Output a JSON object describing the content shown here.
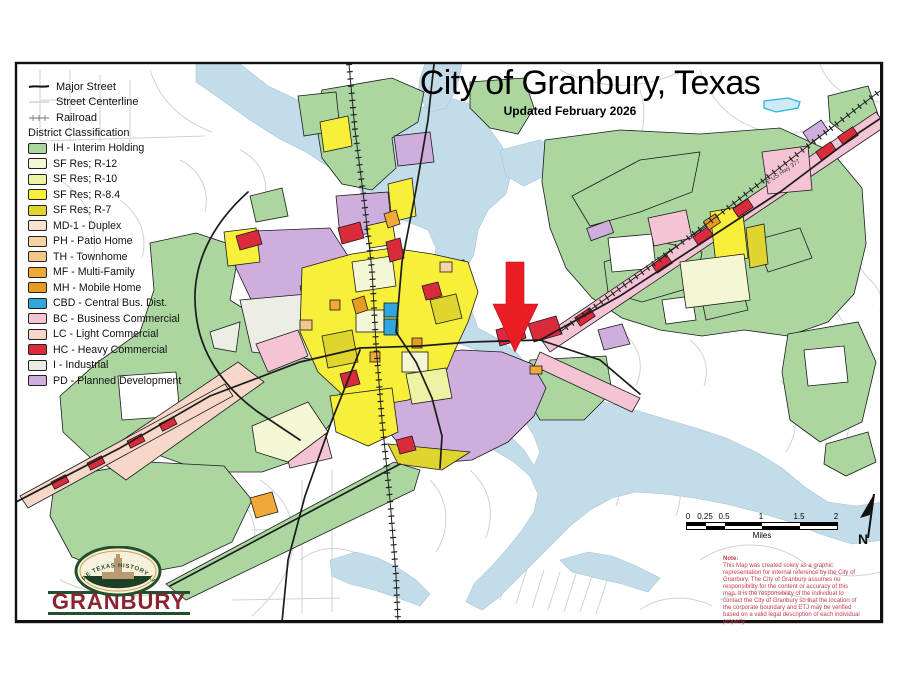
{
  "title": "City of Granbury, Texas",
  "subtitle": "Updated February 2026",
  "legend": {
    "line_items": [
      {
        "label": "Major Street"
      },
      {
        "label": "Street Centerline"
      },
      {
        "label": "Railroad"
      }
    ],
    "section_header": "District Classification",
    "districts": [
      {
        "label": "IH - Interim Holding",
        "color": "#abd69f"
      },
      {
        "label": "SF Res; R-12",
        "color": "#f4f6d4"
      },
      {
        "label": "SF Res; R-10",
        "color": "#eef3a3"
      },
      {
        "label": "SF Res; R-8.4",
        "color": "#f7ef3a"
      },
      {
        "label": "SF Res; R-7",
        "color": "#e0d52e"
      },
      {
        "label": "MD-1 - Duplex",
        "color": "#f7e3cf"
      },
      {
        "label": "PH - Patio Home",
        "color": "#f6d3a4"
      },
      {
        "label": "TH - Townhome",
        "color": "#f2c98a"
      },
      {
        "label": "MF - Multi-Family",
        "color": "#f0a939"
      },
      {
        "label": "MH - Mobile Home",
        "color": "#e79b23"
      },
      {
        "label": "CBD - Central Bus. Dist.",
        "color": "#2fa7dd"
      },
      {
        "label": "BC - Business Commercial",
        "color": "#f4c4d4"
      },
      {
        "label": "LC - Light Commercial",
        "color": "#f6d7c8"
      },
      {
        "label": "HC - Heavy Commercial",
        "color": "#d92b3c"
      },
      {
        "label": "I - Industrial",
        "color": "#eceee6"
      },
      {
        "label": "PD - Planned Development",
        "color": "#cfaede"
      }
    ]
  },
  "scale_bar": {
    "ticks": [
      "0",
      "0.25",
      "0.5",
      "1",
      "1.5",
      "2"
    ],
    "unit": "Miles"
  },
  "north": {
    "label": "N"
  },
  "note": {
    "heading": "Note:",
    "body": "This Map was created solely as a graphic representation for internal reference by the City of Granbury. The City of Granbury assumes no responsibility for the content or accuracy of this map. It is the responsibility of the individual to contact the City of Granbury so that the location of the corporate boundary and ETJ may be verified based on a valid legal description of each individual property."
  },
  "logo": {
    "arc_text": "WHERE TEXAS HISTORY LIVES",
    "name": "GRANBURY"
  },
  "map_labels": {
    "highway": "E US Hwy 377"
  },
  "annotation": {
    "arrow_color": "#ea1c24"
  }
}
